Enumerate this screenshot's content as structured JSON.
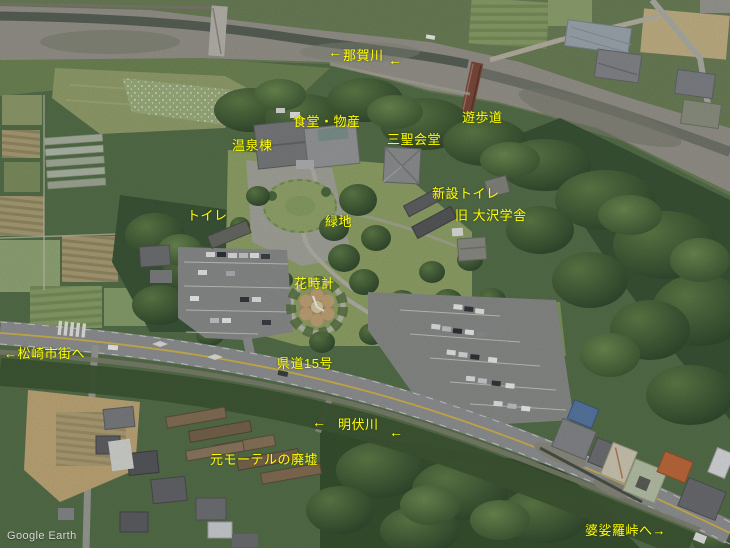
{
  "app": {
    "watermark": "Google Earth"
  },
  "colors": {
    "label": "#ffff00",
    "watermark_text": "#ffffff",
    "road_centerline": "#d2b44e",
    "forest": "#3a5436",
    "river_gravel": "#96948b"
  },
  "map_labels": {
    "nakagawa": {
      "arrow_left": "←",
      "text": "那賀川",
      "arrow_right": "←"
    },
    "shokudo_bussan": {
      "text": "食堂・物産"
    },
    "yuhodo": {
      "text": "遊歩道"
    },
    "onsento": {
      "text": "温泉棟"
    },
    "sansei_kaido": {
      "text": "三聖会堂"
    },
    "shinsetsu_toilet": {
      "text": "新設トイレ"
    },
    "toilet": {
      "text": "トイレ"
    },
    "ryokuchi": {
      "text": "緑地"
    },
    "kyu_osawa_gakusha": {
      "text": "旧 大沢学舎"
    },
    "hanadokei": {
      "text": "花時計"
    },
    "matsuzaki_shigai": {
      "text": "←松崎市街へ"
    },
    "kendo_15": {
      "text": "県道15号"
    },
    "myobusegawa": {
      "arrow_left": "←",
      "text": "明伏川",
      "arrow_right": "←"
    },
    "moto_motel": {
      "text": "元モーテルの廃墟"
    },
    "basara_toge": {
      "text": "婆娑羅峠へ→"
    }
  }
}
